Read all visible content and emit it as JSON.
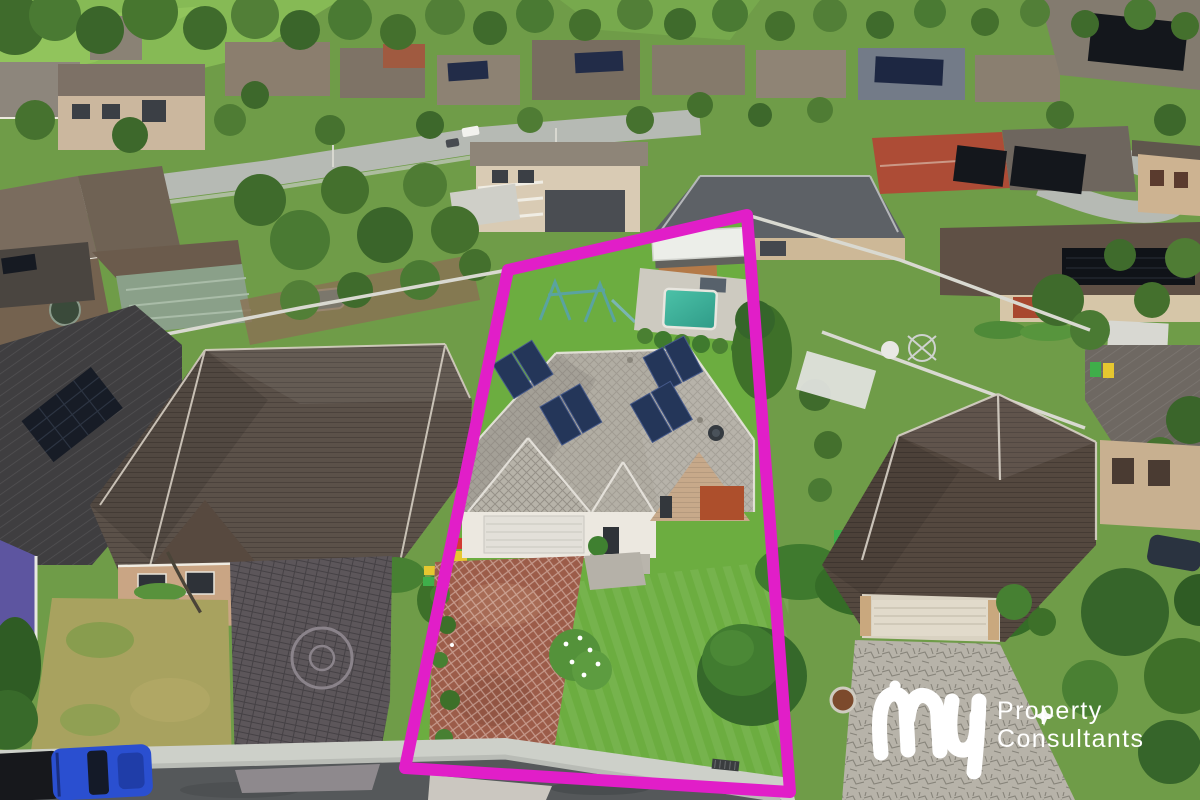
{
  "meta": {
    "width": 1200,
    "height": 800,
    "kind": "aerial-real-estate-photo"
  },
  "watermark": {
    "script_word": "my",
    "line1": "Property",
    "line2": "Consultants",
    "color": "#ffffff"
  },
  "listing_highlight": {
    "boundary_points": "508,270 747,215 790,792 405,768",
    "boundary_color": "#e11ec8",
    "boundary_stroke_width": "12"
  },
  "scene": {
    "subject_solar_panel_count": 8,
    "colors": {
      "lawn": "#6cad40",
      "pool_water": "#3db39b",
      "solar_panel": "#243659",
      "subject_roof": "#b1ada3",
      "left_neighbor_roof": "#5b5149",
      "right_neighbor_roof": "#54483f",
      "subject_driveway": "#9c5c49",
      "left_driveway": "#5c565a",
      "right_driveway": "#b7b3a9",
      "road": "#55585a",
      "footpath": "#cdd0c9",
      "pickup_truck": "#2a4fd0",
      "feature_wall": "#ad4f2c",
      "red_roof_neighbor": "#ad4c36"
    }
  }
}
